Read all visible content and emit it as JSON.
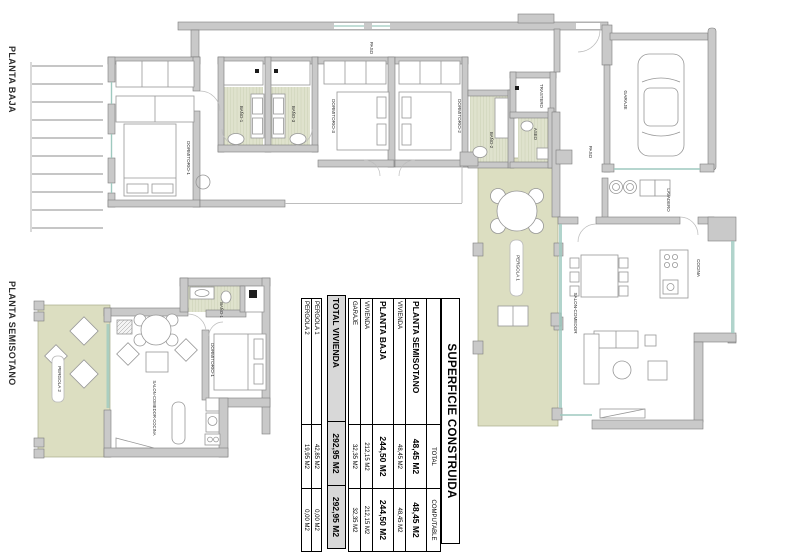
{
  "document": {
    "type": "architectural-floor-plan",
    "background": "#ffffff"
  },
  "plans": {
    "planta_baja": {
      "title": "PLANTA BAJA",
      "rooms": {
        "paso_top": "PASO",
        "dormitorio1": "DORMITORIO-1",
        "bano1": "BAÑO-1",
        "bano3": "BAÑO-3",
        "dormitorio3": "DORMITORIO-3",
        "dormitorio2": "DORMITORIO-2",
        "bano2": "BAÑO-2",
        "aseo": "ASEO",
        "trastero": "TRASTERO",
        "garaje": "GARAJE",
        "paso_entry": "PASO",
        "lavadero": "LAVADERO",
        "cocina": "COCINA",
        "salon_comedor": "SALON-COMEDOR",
        "pergola1": "PERGOLA 1"
      }
    },
    "planta_semisotano": {
      "title": "PLANTA SEMISOTANO",
      "rooms": {
        "pergola2": "PERGOLA 2",
        "bano1": "BAÑO-1",
        "dormitorio1": "DORMITORIO-1",
        "salon_comedor_cocina": "SALON-COMEDOR-COCINA"
      }
    }
  },
  "table": {
    "title": "SUPERFICIE CONSTRUIDA",
    "header": {
      "total": "TOTAL",
      "computable": "COMPUTABLE"
    },
    "rows": [
      {
        "label": "PLANTA SEMISOTANO",
        "total": "48,45 M2",
        "computable": "48,45 M2"
      },
      {
        "label": "VIVIENDA",
        "total": "48,45 M2",
        "computable": "48,45 M2"
      },
      {
        "label": "PLANTA BAJA",
        "total": "244,50 M2",
        "computable": "244,50 M2"
      },
      {
        "label": "VIVIENDA",
        "total": "212,15 M2",
        "computable": "212,15 M2"
      },
      {
        "label": "GARAJE",
        "total": "32,35 M2",
        "computable": "32,35 M2"
      }
    ],
    "total_row": {
      "label": "TOTAL VIVIENDA",
      "total": "292,95 M2",
      "computable": "292,95 M2"
    },
    "pergola_rows": [
      {
        "label": "PERGOLA 1",
        "total": "42,85 M2",
        "computable": "0,00 M2"
      },
      {
        "label": "PERGOLA 2",
        "total": "19,95 M2",
        "computable": "0,00 M2"
      }
    ]
  },
  "colors": {
    "wall": "#c9c9c9",
    "wall_edge": "#7d7d7d",
    "tile_floor": "#dfe2cd",
    "tile_stripe": "#c3c9ab",
    "pergola_floor": "#dcdec1",
    "window_glass": "#9ec9bf",
    "highlight_row": "#d8d8d8"
  }
}
